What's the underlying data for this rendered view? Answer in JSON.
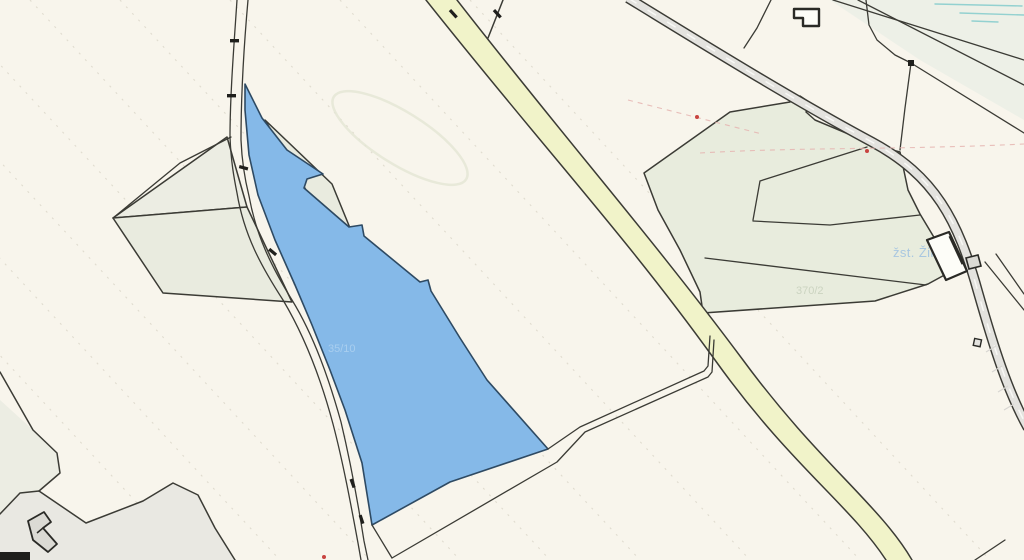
{
  "map": {
    "type": "cadastral-parcel-map",
    "labels": {
      "station_label": "žst. Žilina",
      "faint_parcel_label_right": "370/2",
      "faint_parcel_label_blue": "35/10"
    },
    "highlighted_parcel": {
      "fill": "#85b9e8",
      "stroke": "#2e4a63"
    },
    "colors": {
      "background": "#f8f5ec",
      "tint_green": "#edf0e7",
      "parcel_green": "#e8ecdd",
      "parcel_gray": "#ecede3",
      "parcel_gray2": "#e9ebdf",
      "parcel_bottom": "#e9e8e2",
      "highlight_fill": "#85b9e8",
      "highlight_stroke": "#2e4a63",
      "road_yellow": "#f1f3c9",
      "road_gray": "#e4e3df",
      "road_dash": "#fafaf7",
      "boundary": "#3b3b35",
      "building_fill": "#fdfdf8",
      "building_stroke": "#2a2a26",
      "building_gray": "#dbdad4",
      "rail_teal": "#8ecfcf",
      "faint_dash": "#dcd7ca",
      "pink_dash": "#e5b4b0",
      "red_dot": "#c84440",
      "label_blue": "#a9c7e0",
      "label_faint_green": "#b9c4ae",
      "label_faint_blue": "#b8d7f2",
      "tick": "#1f1f1c",
      "blob": "#e3e6d5"
    }
  }
}
